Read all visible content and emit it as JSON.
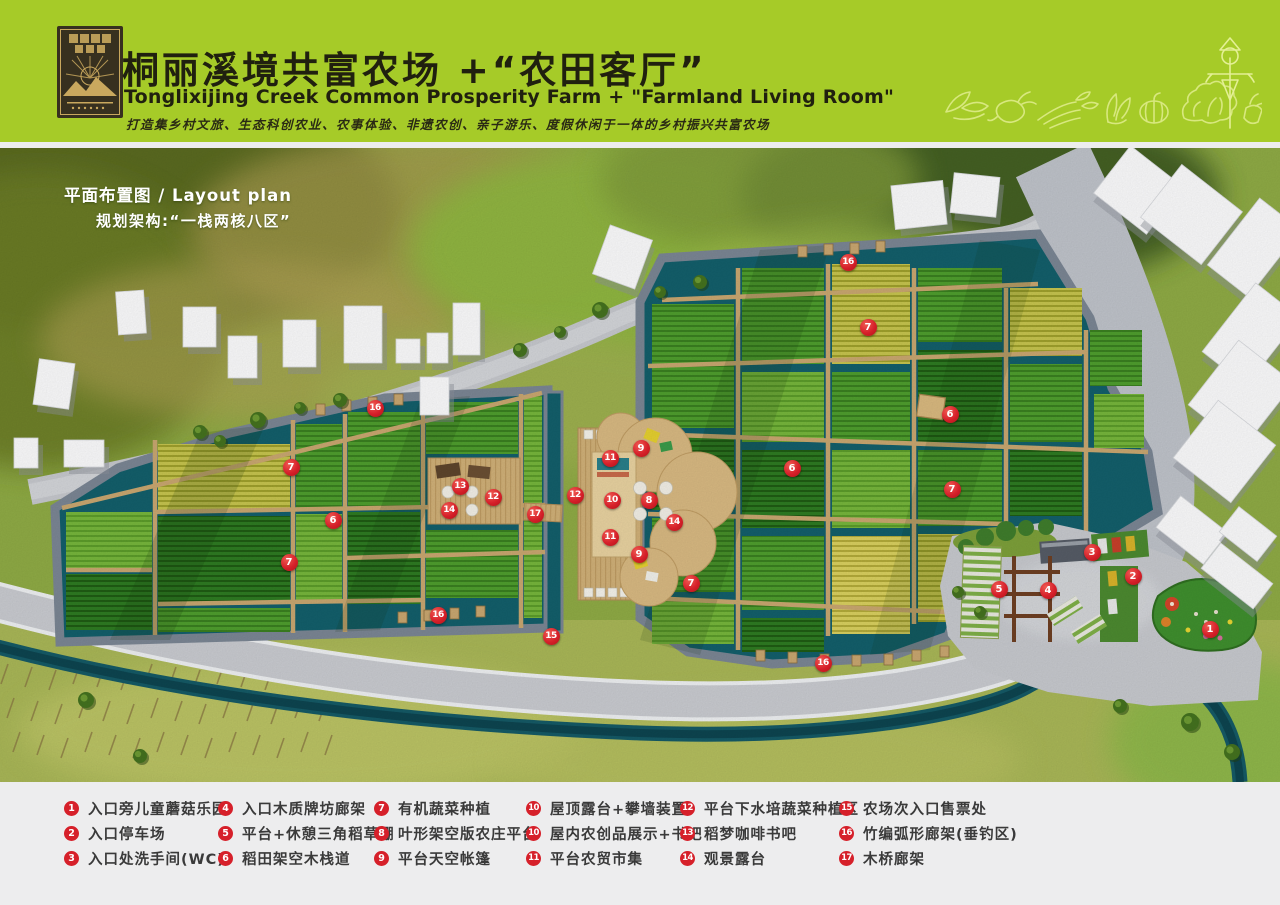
{
  "header": {
    "title_cn": "桐丽溪境共富农场 +“农田客厅”",
    "title_en": "Tonglixijing Creek Common Prosperity Farm + \"Farmland Living Room\"",
    "tagline": "打造集乡村文旅、生态科创农业、农事体验、非遗农创、亲子游乐、度假休闲于一体的乡村振兴共富农场",
    "bg_color": "#a6cb28",
    "icons": [
      "sprout-icon",
      "radish-icon",
      "celery-icon",
      "bokchoy-icon",
      "pumpkin-icon",
      "lettuce-icon",
      "scarecrow-icon",
      "turnip-icon"
    ]
  },
  "map": {
    "label_line1": "平面布置图 / Layout plan",
    "label_line2": "规划架构:“一栈两核八区”",
    "markers": [
      {
        "n": "1",
        "x": 1210,
        "y": 629
      },
      {
        "n": "2",
        "x": 1133,
        "y": 576
      },
      {
        "n": "3",
        "x": 1092,
        "y": 552
      },
      {
        "n": "4",
        "x": 1048,
        "y": 590
      },
      {
        "n": "5",
        "x": 999,
        "y": 589
      },
      {
        "n": "6",
        "x": 333,
        "y": 520
      },
      {
        "n": "6",
        "x": 792,
        "y": 468
      },
      {
        "n": "6",
        "x": 950,
        "y": 414
      },
      {
        "n": "7",
        "x": 291,
        "y": 467
      },
      {
        "n": "7",
        "x": 289,
        "y": 562
      },
      {
        "n": "7",
        "x": 691,
        "y": 583
      },
      {
        "n": "7",
        "x": 868,
        "y": 327
      },
      {
        "n": "7",
        "x": 952,
        "y": 489
      },
      {
        "n": "8",
        "x": 649,
        "y": 500
      },
      {
        "n": "9",
        "x": 641,
        "y": 448
      },
      {
        "n": "9",
        "x": 639,
        "y": 554
      },
      {
        "n": "10",
        "x": 612,
        "y": 500
      },
      {
        "n": "11",
        "x": 610,
        "y": 458
      },
      {
        "n": "11",
        "x": 610,
        "y": 537
      },
      {
        "n": "12",
        "x": 575,
        "y": 495
      },
      {
        "n": "12",
        "x": 493,
        "y": 497
      },
      {
        "n": "13",
        "x": 460,
        "y": 486
      },
      {
        "n": "14",
        "x": 449,
        "y": 510
      },
      {
        "n": "14",
        "x": 674,
        "y": 522
      },
      {
        "n": "15",
        "x": 551,
        "y": 636
      },
      {
        "n": "16",
        "x": 375,
        "y": 408
      },
      {
        "n": "16",
        "x": 848,
        "y": 262
      },
      {
        "n": "16",
        "x": 438,
        "y": 615
      },
      {
        "n": "16",
        "x": 823,
        "y": 663
      },
      {
        "n": "17",
        "x": 535,
        "y": 514
      }
    ]
  },
  "legend": {
    "marker_color": "#d6202a",
    "items": [
      {
        "n": "1",
        "label": "入口旁儿童蘑菇乐园"
      },
      {
        "n": "2",
        "label": "入口停车场"
      },
      {
        "n": "3",
        "label": "入口处洗手间(WC)"
      },
      {
        "n": "4",
        "label": "入口木质牌坊廊架"
      },
      {
        "n": "5",
        "label": "平台+休憩三角稻草棚"
      },
      {
        "n": "6",
        "label": "稻田架空木栈道"
      },
      {
        "n": "7",
        "label": "有机蔬菜种植"
      },
      {
        "n": "8",
        "label": "叶形架空版农庄平台"
      },
      {
        "n": "9",
        "label": "平台天空帐篷"
      },
      {
        "n": "10",
        "label": "屋顶露台+攀墙装置"
      },
      {
        "n": "10",
        "label": "屋内农创品展示+书吧"
      },
      {
        "n": "11",
        "label": "平台农贸市集"
      },
      {
        "n": "12",
        "label": "平台下水培蔬菜种植区"
      },
      {
        "n": "13",
        "label": "稻梦咖啡书吧"
      },
      {
        "n": "14",
        "label": "观景露台"
      },
      {
        "n": "15",
        "label": "农场次入口售票处"
      },
      {
        "n": "16",
        "label": "竹编弧形廊架(垂钓区)"
      },
      {
        "n": "17",
        "label": "木桥廊架"
      }
    ]
  }
}
